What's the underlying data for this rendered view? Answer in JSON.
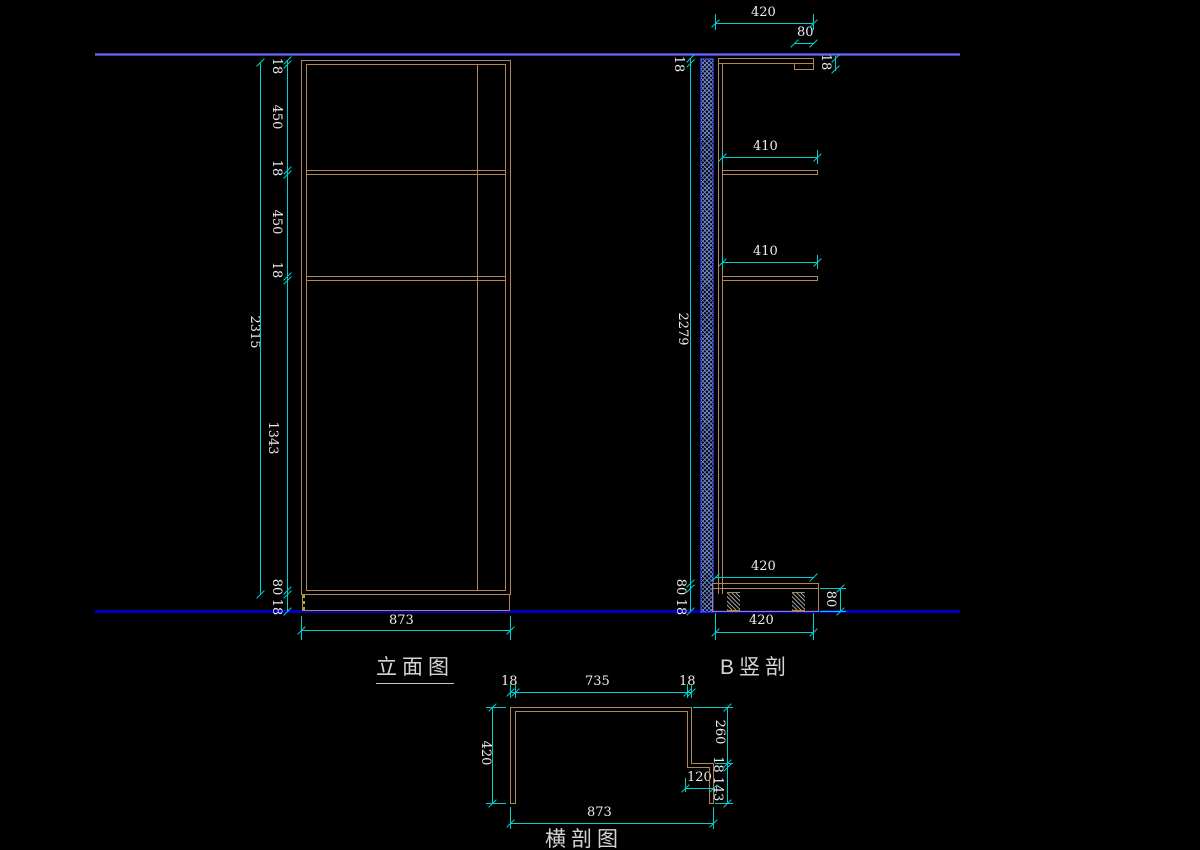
{
  "labels": {
    "elevation": "立面图",
    "section_b": "B竖剖",
    "plan": "横剖图"
  },
  "elevation": {
    "chain": [
      "18",
      "450",
      "18",
      "450",
      "18",
      "1343"
    ],
    "overall": "2315",
    "bottom": [
      "80",
      "18"
    ],
    "width": "873"
  },
  "section_b": {
    "top_width": "420",
    "top_offset": "80",
    "board_right": "18",
    "board_left": "18",
    "height": "2279",
    "shelves": [
      "410",
      "410"
    ],
    "above_base": "420",
    "below_base": "420",
    "base_height": "80",
    "bottom": [
      "80",
      "18"
    ]
  },
  "plan": {
    "top": [
      "18",
      "735",
      "18"
    ],
    "depth": "420",
    "right": [
      "260",
      "18",
      "143"
    ],
    "notch": "120",
    "width": "873"
  },
  "colors": {
    "background": "#000000",
    "cabinet_line": "#B08756",
    "dimension": "#00CFCF",
    "dim_text": "#EDEDED",
    "ceiling_line": "#5A5AD8",
    "floor_line": "#0000C0",
    "wall_border": "#2222DD",
    "wall_hatch": "#7896E1",
    "hidden_line": "#B0B000",
    "label_text": "#D4D4D4"
  }
}
